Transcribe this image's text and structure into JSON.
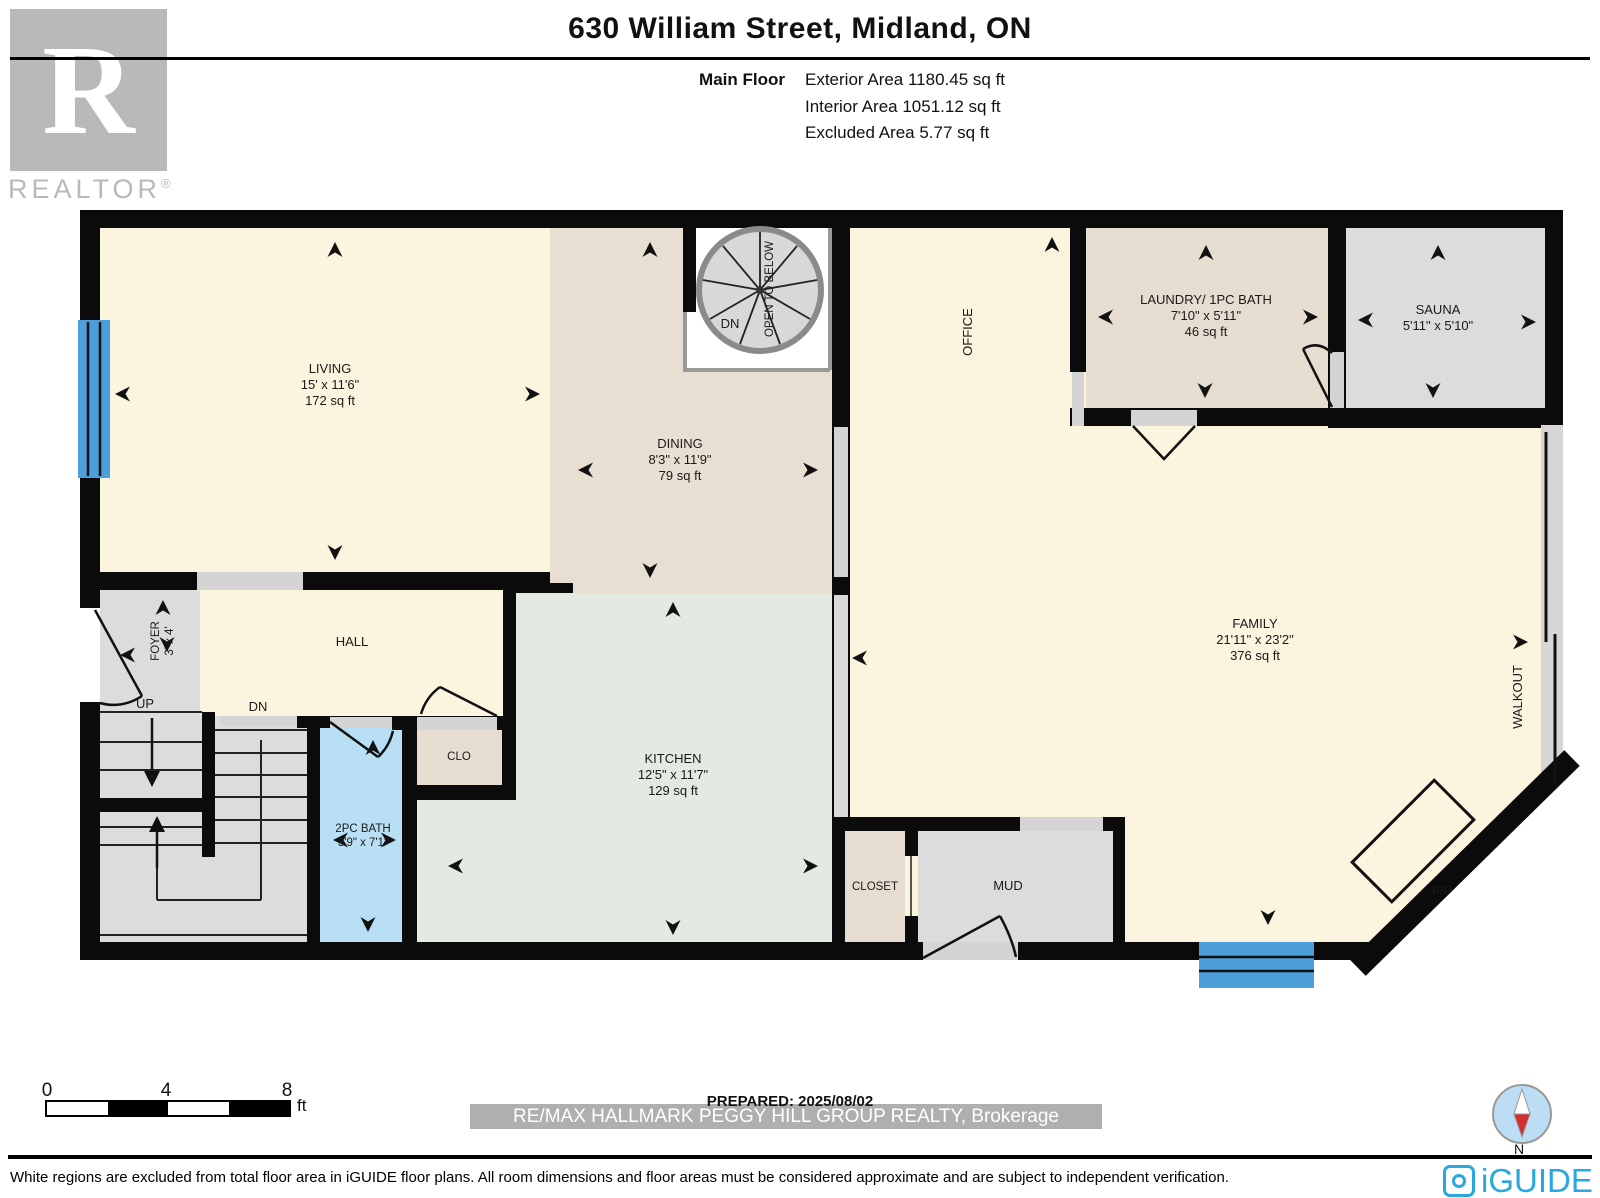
{
  "header": {
    "title": "630 William Street, Midland, ON",
    "floor_label": "Main Floor",
    "exterior_area": "Exterior Area 1180.45 sq ft",
    "interior_area": "Interior Area 1051.12 sq ft",
    "excluded_area": "Excluded Area 5.77 sq ft"
  },
  "branding": {
    "realtor_r": "R",
    "realtor_word": "REALTOR",
    "registered": "®",
    "iguide": "iGUIDE",
    "compass_n": "N"
  },
  "rooms": {
    "living": {
      "name": "LIVING",
      "dims": "15' x 11'6\"",
      "area": "172 sq ft"
    },
    "dining": {
      "name": "DINING",
      "dims": "8'3\" x 11'9\"",
      "area": "79 sq ft"
    },
    "kitchen": {
      "name": "KITCHEN",
      "dims": "12'5\" x 11'7\"",
      "area": "129 sq ft"
    },
    "family": {
      "name": "FAMILY",
      "dims": "21'11\" x 23'2\"",
      "area": "376 sq ft"
    },
    "laundry": {
      "name": "LAUNDRY/ 1PC BATH",
      "dims": "7'10\" x 5'11\"",
      "area": "46 sq ft"
    },
    "sauna": {
      "name": "SAUNA",
      "dims": "5'11\" x 5'10\""
    },
    "bath": {
      "name": "2PC BATH",
      "dims": "3'9\" x 7'1\""
    },
    "foyer": {
      "name": "FOYER",
      "dims": "3' x 4'"
    },
    "office": {
      "name": "OFFICE"
    },
    "hall": {
      "name": "HALL"
    },
    "clo": {
      "name": "CLO"
    },
    "closet": {
      "name": "CLOSET"
    },
    "mud": {
      "name": "MUD"
    },
    "walkout": {
      "name": "WALKOUT"
    },
    "fireplace": {
      "name": "F/P"
    },
    "open_below": {
      "name": "OPEN TO BELOW"
    },
    "stairs": {
      "up": "UP",
      "dn": "DN"
    },
    "spiral_dn": "DN"
  },
  "footer": {
    "scale": {
      "t0": "0",
      "t4": "4",
      "t8": "8",
      "unit": "ft"
    },
    "prepared": "PREPARED: 2025/08/02",
    "watermark": "RE/MAX HALLMARK PEGGY HILL GROUP REALTY, Brokerage",
    "disclaimer": "White regions are excluded from total floor area in iGUIDE floor plans. All room dimensions and floor areas must be considered approximate and are subject to independent verification."
  },
  "colors": {
    "wall": "#0b0b0b",
    "cream": "#FBF4DF",
    "dining_tan": "#E8DFD2",
    "kitchen_green": "#E3EAE2",
    "bath_blue": "#B9DFF5",
    "gray_room": "#DCDCDC",
    "closet_beige": "#E7DCD0",
    "window_blue": "#4C9FD8",
    "iguide_blue": "#2AA7DF",
    "logo_gray": "#B9B9B9"
  }
}
